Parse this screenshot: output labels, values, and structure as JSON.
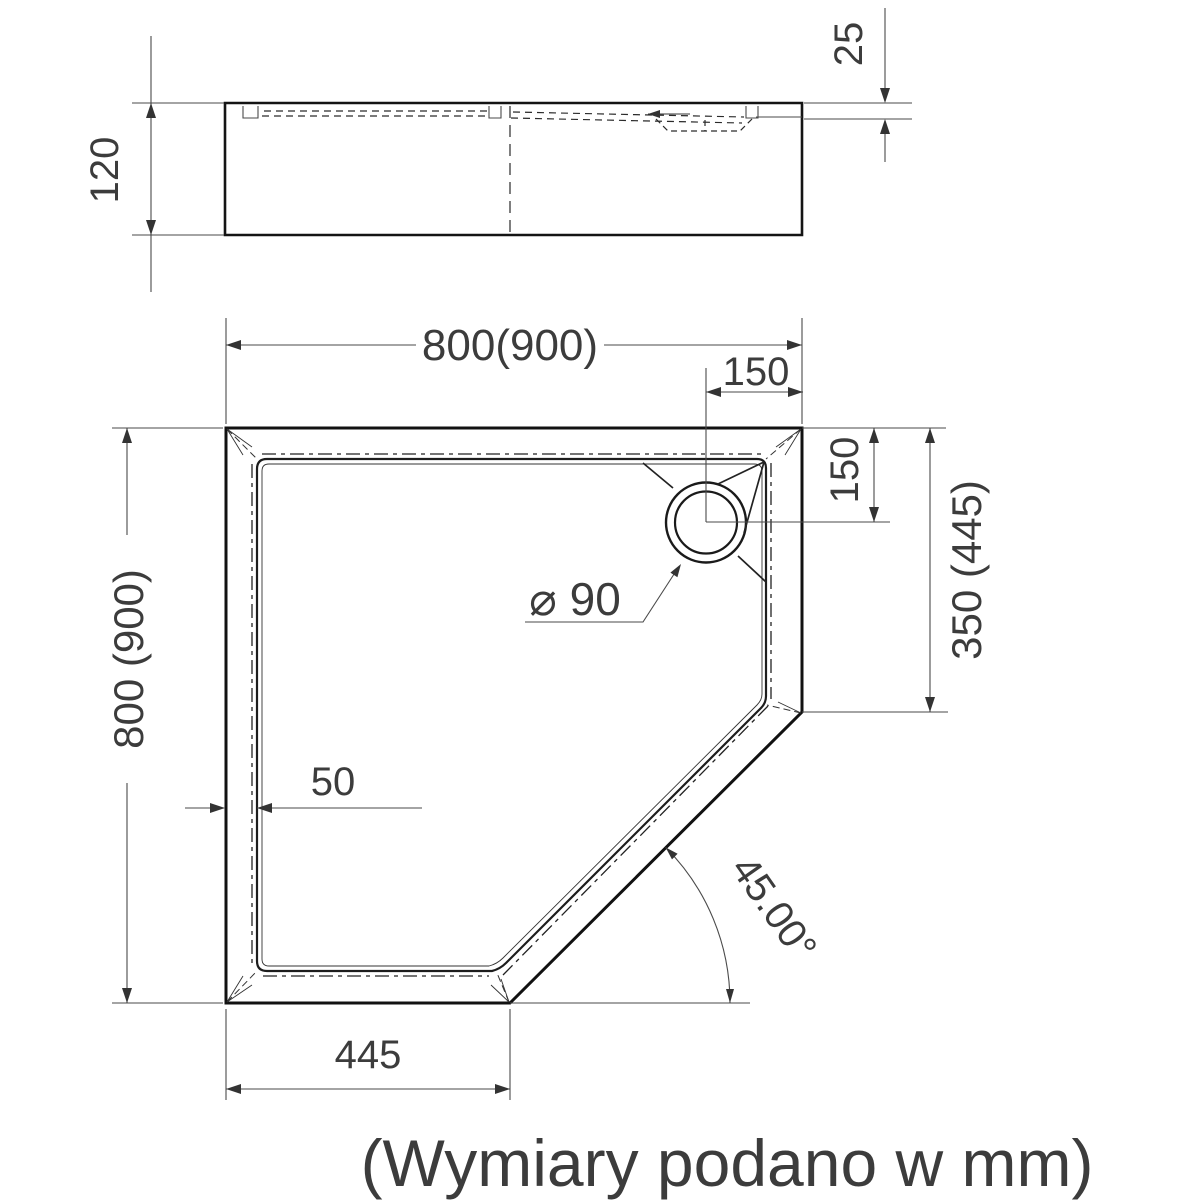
{
  "drawing": {
    "caption": "(Wymiary podano w mm)",
    "side_view": {
      "height": "120",
      "rim_depth": "25"
    },
    "plan_view": {
      "width": "800(900)",
      "height": "800 (900)",
      "drain_offset_top": "150",
      "drain_offset_right": "150",
      "corner_span": "350 (445)",
      "wall_thickness": "50",
      "drain_diameter": "⌀ 90",
      "front_edge": "445",
      "corner_angle": "45.00°"
    }
  }
}
